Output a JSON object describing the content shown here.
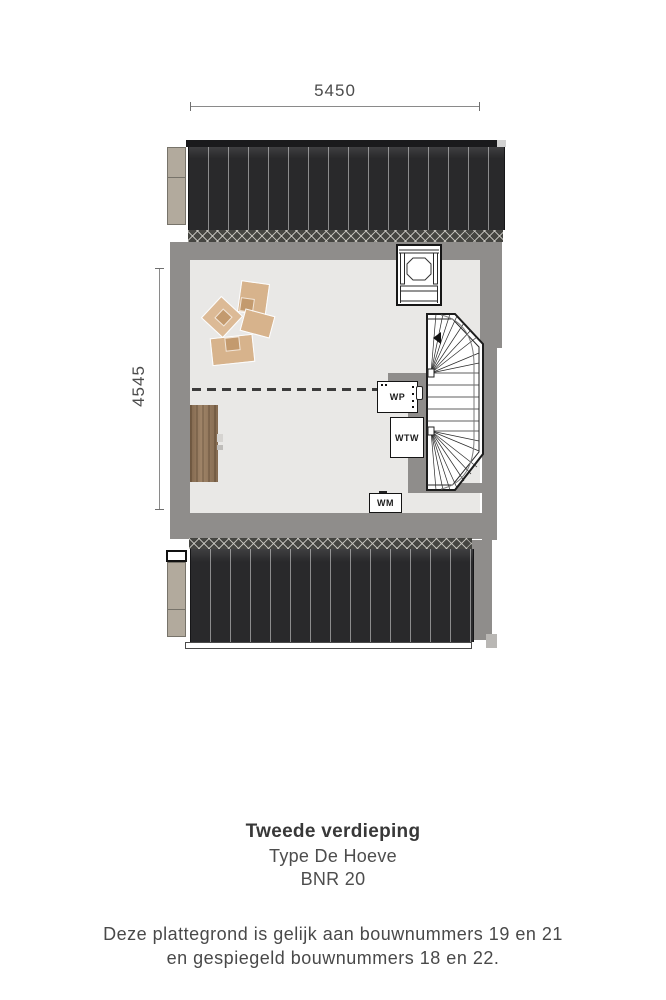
{
  "plan": {
    "dim_width": "5450",
    "dim_height": "4545",
    "units": {
      "wp": "WP",
      "wtw": "WTW",
      "wm": "WM"
    },
    "stair_arrow_direction": "left"
  },
  "caption": {
    "floor_title": "Tweede verdieping",
    "type_line": "Type De Hoeve",
    "bnr_line": "BNR 20",
    "note_line1": "Deze plattegrond is gelijk aan bouwnummers 19 en 21",
    "note_line2": "en gespiegeld bouwnummers 18 en 22."
  },
  "colors": {
    "roof_dark": "#29292b",
    "wall_gray": "#8f8d8b",
    "floor_light": "#e9e8e6",
    "hatch_dark": "#454541",
    "neighbor_block_beige": "#b2aa9d",
    "desk_wood": "#97795b",
    "furniture_tan": "#d7b38c",
    "text_dark": "#383838",
    "dim_text": "#4b4b4b"
  }
}
